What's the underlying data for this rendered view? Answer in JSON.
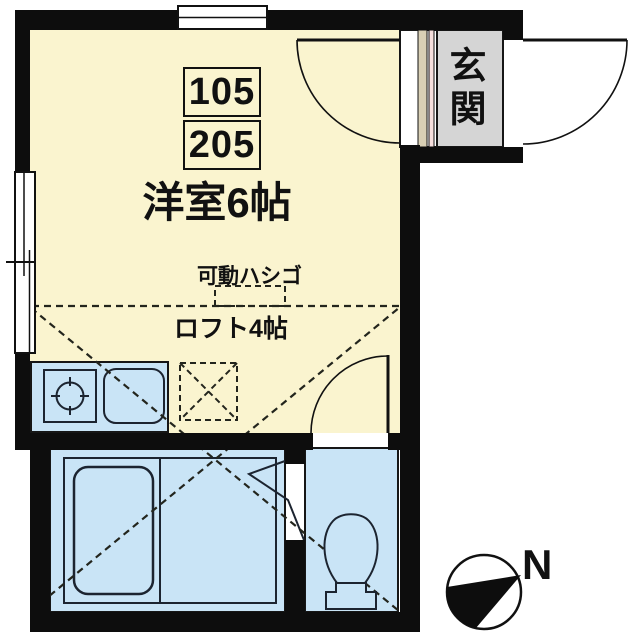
{
  "floorplan": {
    "labels": {
      "unit_numbers": [
        "105",
        "205"
      ],
      "room": "洋室6帖",
      "ladder": "可動ハシゴ",
      "loft": "ロフト4帖",
      "entrance": "玄関",
      "compass_north": "N"
    },
    "colors": {
      "wall": "#0d0d0d",
      "room_floor": "#faf4cf",
      "wet_area": "#c9e4f6",
      "entrance_floor": "#d5d5d5",
      "threshold_beige": "#d9d0b5",
      "threshold_pink": "#f6dfdd",
      "doorway_floor": "#ffffff",
      "background": "#ffffff"
    }
  }
}
